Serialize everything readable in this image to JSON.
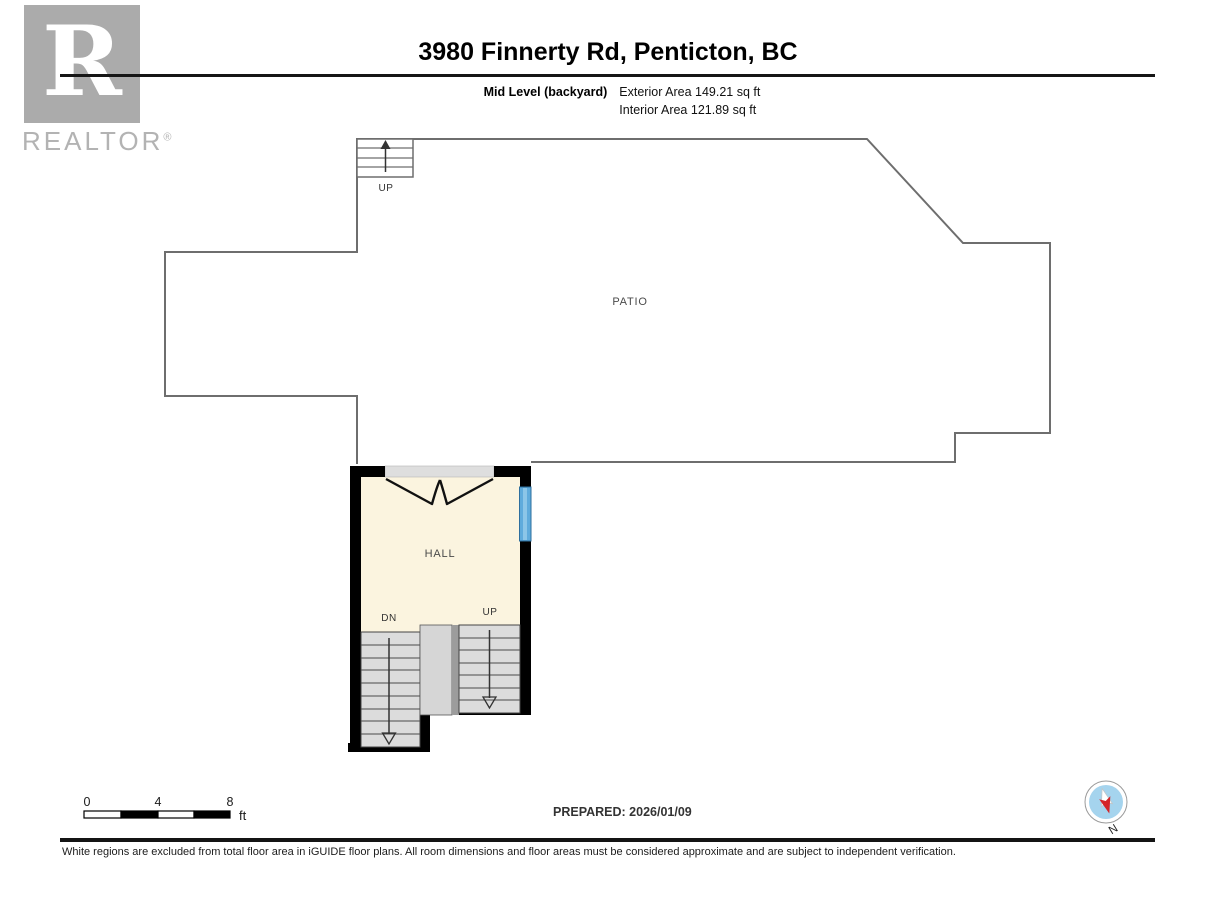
{
  "branding": {
    "logo_letter": "R",
    "wordmark": "REALTOR",
    "registered": "®"
  },
  "header": {
    "title": "3980 Finnerty Rd, Penticton, BC",
    "level_label": "Mid Level (backyard)",
    "exterior_area": "Exterior Area 149.21 sq ft",
    "interior_area": "Interior Area 121.89 sq ft"
  },
  "plan": {
    "patio_label": "PATIO",
    "hall_label": "HALL",
    "top_stairs_label": "UP",
    "dn_label": "DN",
    "up_label": "UP",
    "colors": {
      "wall": "#000000",
      "outline": "#6e6e6e",
      "interior": "#fbf4df",
      "stair": "#dcdcdc",
      "landing": "#d6d6d6",
      "divider": "#9c9c9c",
      "window": "#5fabdc",
      "window_center": "#8cc6e8",
      "door_header": "#dedede"
    }
  },
  "scale_bar": {
    "tick_0": "0",
    "tick_4": "4",
    "tick_8": "8",
    "unit": "ft"
  },
  "prepared": {
    "label": "PREPARED: 2026/01/09"
  },
  "compass": {
    "north_label": "N"
  },
  "disclaimer": "White regions are excluded from total floor area in iGUIDE floor plans. All room dimensions and floor areas must be considered approximate and are subject to independent verification."
}
